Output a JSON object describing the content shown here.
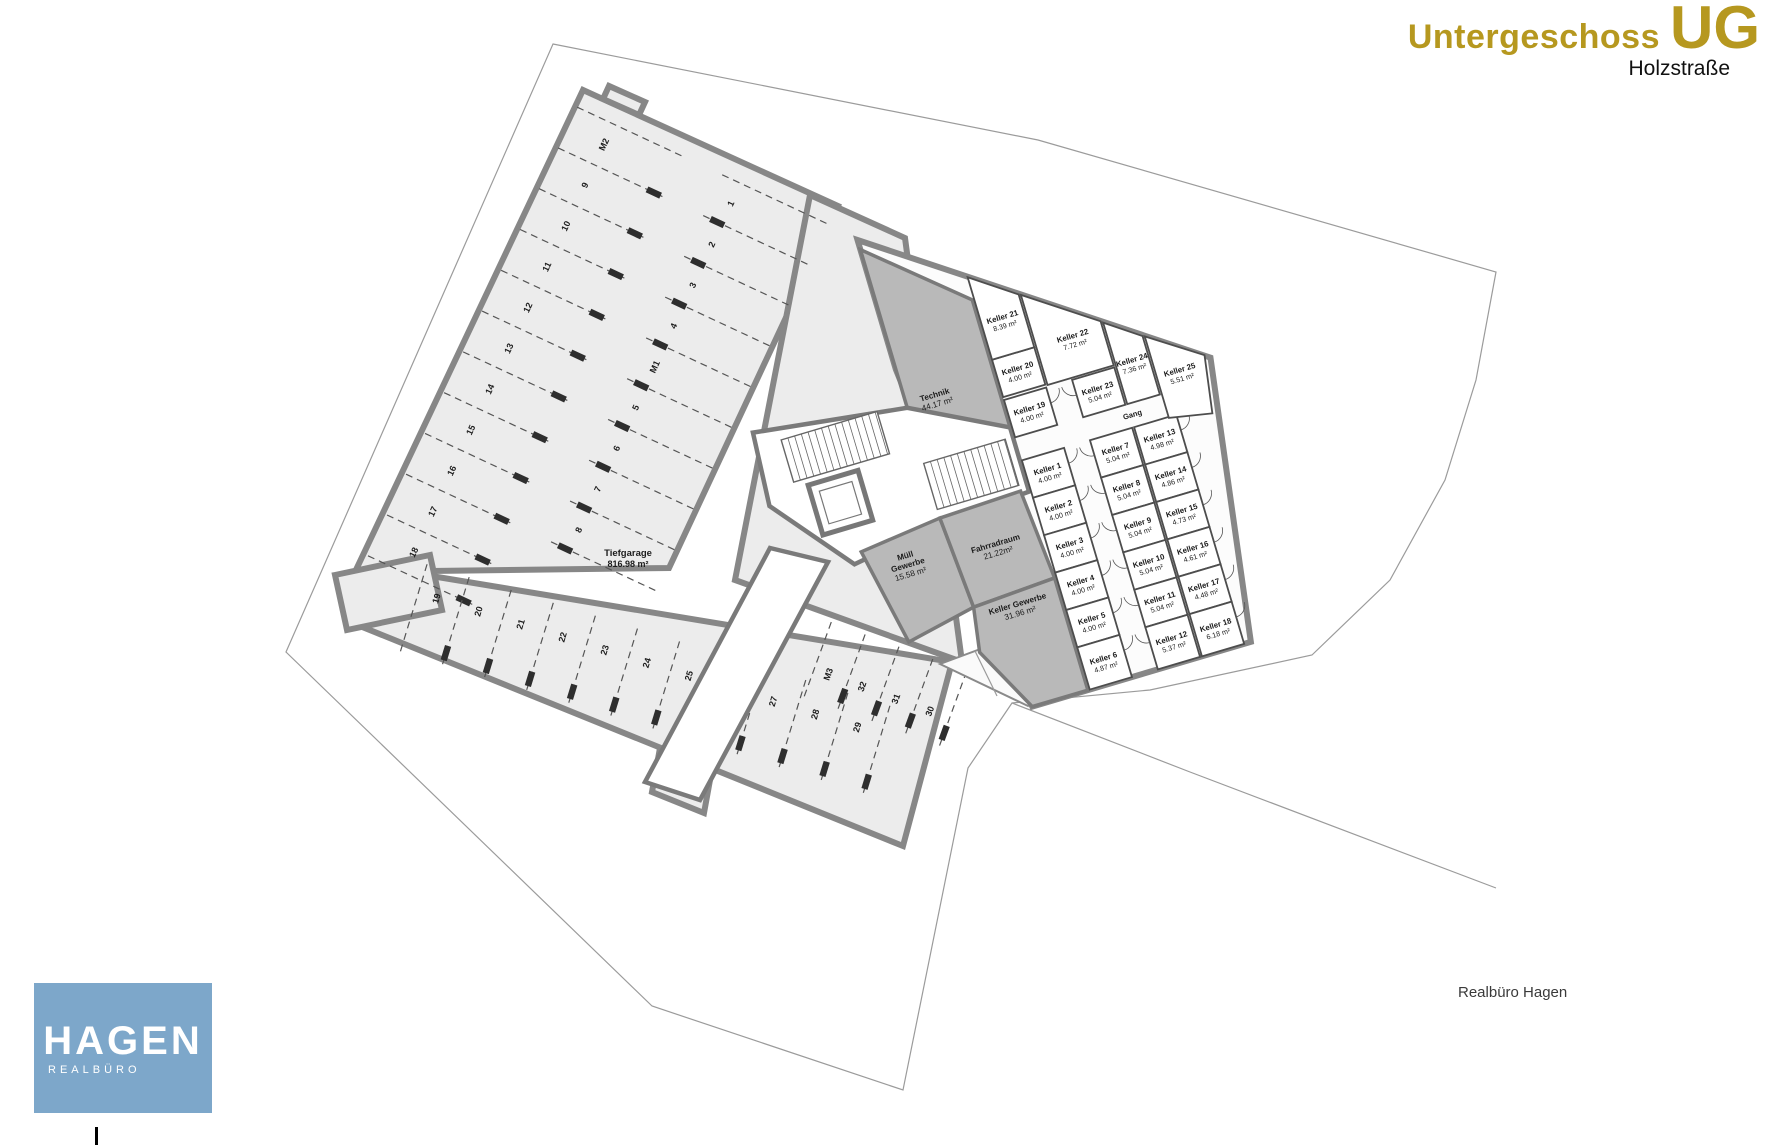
{
  "header": {
    "floor_name": "Untergeschoss",
    "floor_abbr": "UG",
    "street": "Holzstraße"
  },
  "footer": {
    "credit": "Realbüro Hagen"
  },
  "logo": {
    "title": "HAGEN",
    "subtitle": "REALBÜRO"
  },
  "colors": {
    "accent_gold": "#b6981f",
    "logo_blue": "#7da7ca",
    "wall_gray": "#878787",
    "room_dark": "#b9b9b9"
  },
  "plan": {
    "garage": {
      "name": "Tiefgarage",
      "area": "816.98 m²"
    },
    "rooms": [
      {
        "id": "technik",
        "name": "Technik",
        "area": "44.17 m²"
      },
      {
        "id": "muell",
        "name": "Müll Gewerbe",
        "area": "15.58 m²"
      },
      {
        "id": "fahrrad",
        "name": "Fahrradraum",
        "area": "21.22m²"
      },
      {
        "id": "kgew",
        "name": "Keller Gewerbe",
        "area": "31.96 m²"
      },
      {
        "id": "gang",
        "name": "Gang",
        "area": ""
      }
    ],
    "cellars": [
      {
        "name": "Keller 1",
        "area": "4.00 m²",
        "col": "A",
        "row": 0
      },
      {
        "name": "Keller 2",
        "area": "4.00 m²",
        "col": "A",
        "row": 1
      },
      {
        "name": "Keller 3",
        "area": "4.00 m²",
        "col": "A",
        "row": 2
      },
      {
        "name": "Keller 4",
        "area": "4.00 m²",
        "col": "A",
        "row": 3
      },
      {
        "name": "Keller 5",
        "area": "4.00 m²",
        "col": "A",
        "row": 4
      },
      {
        "name": "Keller 6",
        "area": "4.87 m²",
        "col": "A",
        "row": 5
      },
      {
        "name": "Keller 7",
        "area": "5.04 m²",
        "col": "B",
        "row": 0
      },
      {
        "name": "Keller 8",
        "area": "5.04 m²",
        "col": "B",
        "row": 1
      },
      {
        "name": "Keller 9",
        "area": "5.04 m²",
        "col": "B",
        "row": 2
      },
      {
        "name": "Keller 10",
        "area": "5.04 m²",
        "col": "B",
        "row": 3
      },
      {
        "name": "Keller 11",
        "area": "5.04 m²",
        "col": "B",
        "row": 4
      },
      {
        "name": "Keller 12",
        "area": "5.37 m²",
        "col": "B",
        "row": 5
      },
      {
        "name": "Keller 13",
        "area": "4.98 m²",
        "col": "C",
        "row": 0
      },
      {
        "name": "Keller 14",
        "area": "4.86 m²",
        "col": "C",
        "row": 1
      },
      {
        "name": "Keller 15",
        "area": "4.73 m²",
        "col": "C",
        "row": 2
      },
      {
        "name": "Keller 16",
        "area": "4.61 m²",
        "col": "C",
        "row": 3
      },
      {
        "name": "Keller 17",
        "area": "4.48 m²",
        "col": "C",
        "row": 4
      },
      {
        "name": "Keller 18",
        "area": "6.18 m²",
        "col": "C",
        "row": 5
      },
      {
        "name": "Keller 19",
        "area": "4.00 m²",
        "col": "A",
        "row": -1
      },
      {
        "name": "Keller 20",
        "area": "4.00 m²",
        "col": "A",
        "row": -2
      },
      {
        "name": "Keller 21",
        "area": "8.39 m²",
        "poly": "0,-128 44,-97 44,-42 0,-42",
        "lx": 22,
        "ly": -76
      },
      {
        "name": "Keller 22",
        "area": "7.72 m²",
        "poly": "46,-96 115,-48 115,-2 46,-2",
        "lx": 84,
        "ly": -38
      },
      {
        "name": "Keller 23",
        "area": "5.04 m²",
        "col": "B",
        "row": -1
      },
      {
        "name": "Keller 24",
        "area": "7.36 m²",
        "poly": "117,-46 151,-22 151,39 117,39",
        "lx": 134,
        "ly": 2
      },
      {
        "name": "Keller 25",
        "area": "5.51 m²",
        "poly": "153,-21 205,14 196,72 153,64",
        "lx": 177,
        "ly": 25
      }
    ],
    "parking": {
      "left_row": [
        "M2",
        "9",
        "10",
        "11",
        "12",
        "13",
        "14",
        "15",
        "16",
        "17",
        "18"
      ],
      "right_row": [
        "1",
        "2",
        "3",
        "4",
        "M1",
        "5",
        "6",
        "7",
        "8"
      ],
      "bottom_row": [
        "19",
        "20",
        "21",
        "22",
        "23",
        "24",
        "25",
        "26",
        "27",
        "28",
        "29"
      ],
      "island_row": [
        "M3",
        "32",
        "31",
        "30"
      ]
    }
  }
}
